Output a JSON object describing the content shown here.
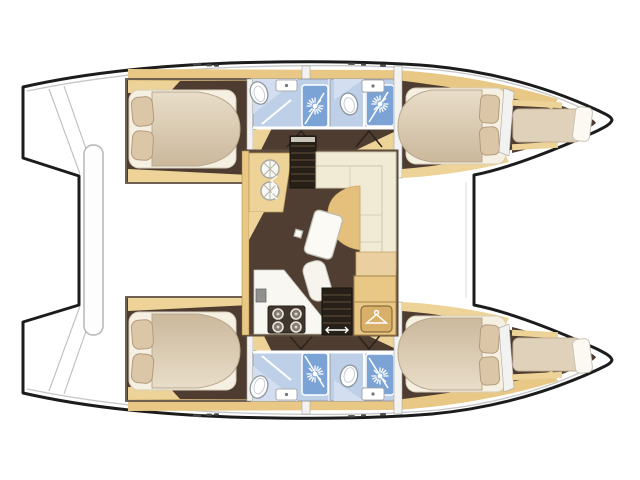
{
  "diagram": {
    "kind": "catamaran-interior-floor-plan",
    "orientation": "bow-right-stern-left",
    "visible_text": []
  },
  "colors": {
    "background": "#ffffff",
    "outline": "#1c1c1c",
    "deck_line": "#c6c6c6",
    "wood": "#e9c886",
    "wood_light": "#eed399",
    "floor": "#4e3c30",
    "floor_saloon": "#4f3e31",
    "stairs": "#262019",
    "mattress": "#f6f0e2",
    "duvet_light": "#e9ddc9",
    "duvet_dark": "#cbb89c",
    "pillow": "#dcc6a8",
    "berth": "#e0d2ba",
    "bath_floor": "#bed0e8",
    "bath_floor_light": "#d3def1",
    "shower": "#7ba3d6",
    "fixture_white": "#ffffff",
    "sofa": "#f1ebd6",
    "cushion": "#e5bf7c",
    "counter_white": "#f8f7f2",
    "stove": "#3f362d",
    "wall_white": "#f2f2f0",
    "saloon_wall": "#5d4c3c"
  },
  "icons": {
    "shower_jet": "starburst-spray",
    "toilet": "oval-bowl",
    "sink": "basin-with-drain-dot",
    "galley_sink": "round-basin-with-spokes",
    "stove": "four-burner-hob",
    "wardrobe_hanger": "clothes-hanger",
    "companionway_steps": "ladder-steps",
    "direction_arrow": "double-headed-arrow",
    "door_swing": "v-lines",
    "cleat": "deck-dash"
  },
  "features": {
    "hulls": 2,
    "double_cabins": 4,
    "bathrooms": 4,
    "showers": 4,
    "toilets": 4,
    "bathroom_sinks": 4,
    "forepeak_berths": 2,
    "galley_burners": 4,
    "galley_sinks": 2,
    "saloon_sofas": 1,
    "saloon_tables": 1,
    "wardrobes": 1,
    "companionway_stairs": 2,
    "aft_platform_bars": 1
  }
}
